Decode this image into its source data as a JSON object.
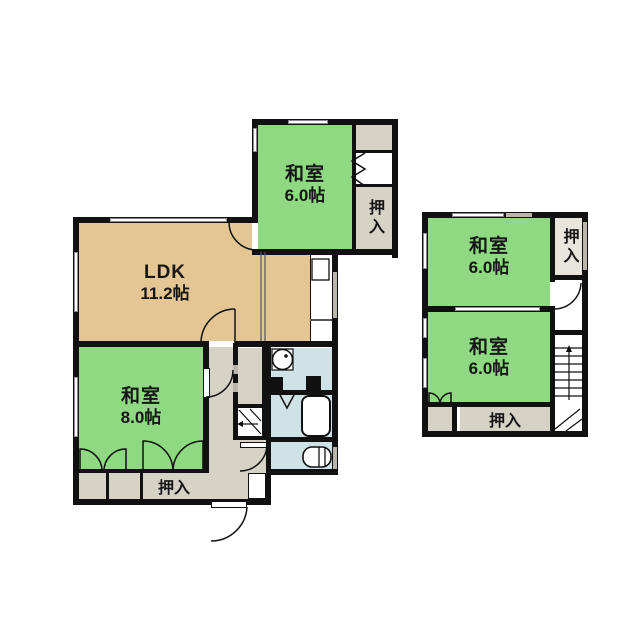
{
  "plan": {
    "floor1": {
      "washitsu_top": {
        "label": "和室",
        "size": "6.0帖"
      },
      "ldk": {
        "label": "LDK",
        "size": "11.2帖"
      },
      "washitsu_main": {
        "label": "和室",
        "size": "8.0帖"
      },
      "closet_top_right": {
        "label": "押入"
      },
      "closet_bottom": {
        "label": "押入"
      }
    },
    "floor2": {
      "washitsu_upper": {
        "label": "和室",
        "size": "6.0帖"
      },
      "washitsu_lower": {
        "label": "和室",
        "size": "6.0帖"
      },
      "closet_top": {
        "label": "押入"
      },
      "closet_bottom": {
        "label": "押入"
      }
    },
    "colors": {
      "tatami_green": "#8fd983",
      "ldk_tan": "#e3c693",
      "service_beige": "#d6d2c5",
      "closet_light": "#e8e5dc",
      "wet_blue": "#cfe2e6",
      "wall_black": "#111111"
    }
  }
}
